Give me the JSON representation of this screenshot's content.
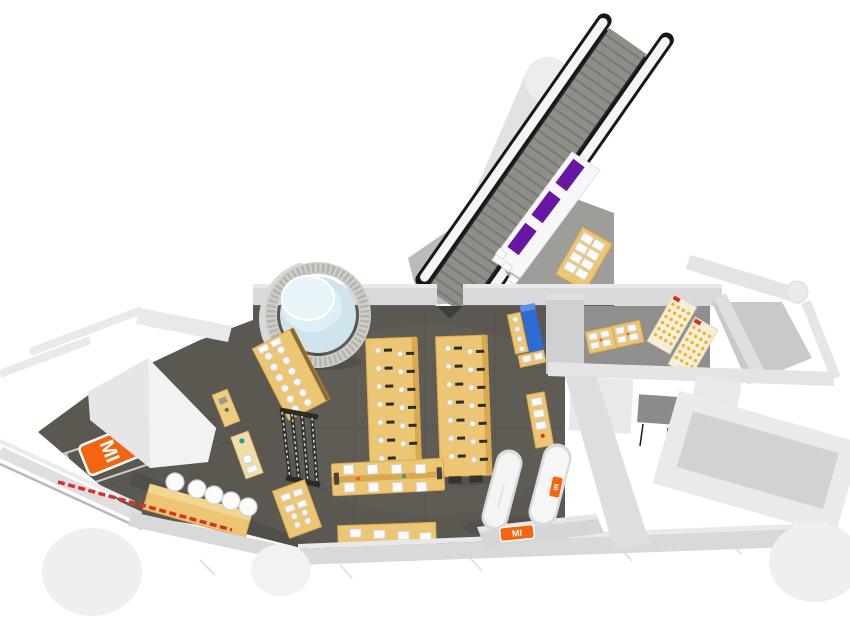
{
  "scene": {
    "title": "Mi Store — 3D bird's-eye floor plan render",
    "description": "Isometric 3D rendering of a Mi retail store interior: escalator to upper level, glass display column, wooden display tables, experience bar with stools, cashier counters and back-office rooms",
    "view": "3d-top-down-render",
    "background": "#ffffff"
  },
  "brand": {
    "name": "Mi",
    "logo_text": "MI",
    "logo_color": "#f4650f",
    "logo_text_color": "#ffffff"
  },
  "palette": {
    "floor_dark": "#5b5852",
    "floor_landing": "#9e9d9a",
    "floor_corridor": "#8f8f8d",
    "wall_light": "#d9d9db",
    "wall_lighter": "#e9e9eb",
    "wall_white": "#f5f5f6",
    "wood": "#ecc674",
    "wood_dark": "#d9a94f",
    "orange": "#f4650f",
    "purple_screen": "#6717a3",
    "glass_blue": "#cfe4ec",
    "display_blue": "#2e6cd2",
    "stripe_red": "#d93025",
    "escalator_step": "#908e89",
    "outline_black": "#17171a",
    "accessory_yellow": "#f0b429"
  },
  "fixtures": {
    "escalator": "escalator to upper level",
    "structural_column": "round structural column",
    "glass_column": "cylindrical glass product display",
    "purple_screen_panels": 3,
    "center_display_tables": 2,
    "experience_bar_stools": 5,
    "cashier_counters": 2,
    "accessory_wall_panels": 2,
    "floor_logo": "Mi logo floor decal",
    "entrance_stripe": "red striped welcome strip",
    "blue_display": "blue backlit display unit"
  }
}
